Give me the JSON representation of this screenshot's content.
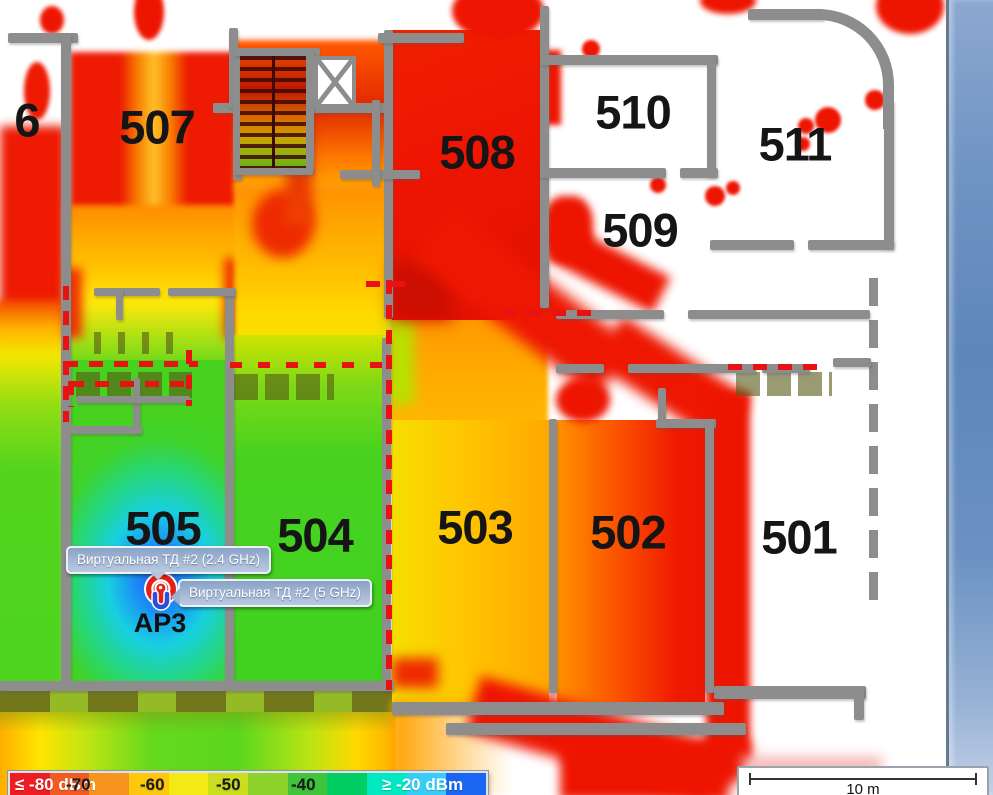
{
  "map": {
    "rooms": [
      {
        "id": "506",
        "label": "6"
      },
      {
        "id": "507",
        "label": "507"
      },
      {
        "id": "508",
        "label": "508"
      },
      {
        "id": "510",
        "label": "510"
      },
      {
        "id": "511",
        "label": "511"
      },
      {
        "id": "509",
        "label": "509"
      },
      {
        "id": "505",
        "label": "505"
      },
      {
        "id": "504",
        "label": "504"
      },
      {
        "id": "503",
        "label": "503"
      },
      {
        "id": "502",
        "label": "502"
      },
      {
        "id": "501",
        "label": "501"
      }
    ]
  },
  "ap": {
    "label": "AP3",
    "tooltip_24ghz": "Виртуальная ТД #2 (2.4 GHz)",
    "tooltip_5ghz": "Виртуальная ТД #2 (5 GHz)"
  },
  "legend": {
    "segments": [
      "#ee1c23",
      "#f15b22",
      "#f7941d",
      "#fdc70c",
      "#f3ea15",
      "#cadd1f",
      "#8ed32c",
      "#3fc43c",
      "#00ce62",
      "#00e9c2",
      "#38cdf6",
      "#1a65f2"
    ],
    "labels": [
      {
        "text": "≤ -80 dBm",
        "color": "#ffffff",
        "x": 5
      },
      {
        "text": "-70",
        "color": "#1a1a1a",
        "x": 56
      },
      {
        "text": "-60",
        "color": "#1a1a1a",
        "x": 130
      },
      {
        "text": "-50",
        "color": "#1a1a1a",
        "x": 206
      },
      {
        "text": "-40",
        "color": "#1a1a1a",
        "x": 281
      },
      {
        "text": "≥ -20 dBm",
        "color": "#ffffff",
        "x": 372
      }
    ]
  },
  "scale_bar": {
    "label": "10 m"
  },
  "colors": {
    "wall": "#8d8d8d",
    "attenuation_wall": "#e81212",
    "tooltip_bg": "#a7bad7",
    "panel_edge_blue": "#6b92c2",
    "heat_weak_red": "#ee1c23",
    "heat_mid_orange": "#f7941d",
    "heat_good_green": "#47d220",
    "heat_strong_cyan": "#17d6cf",
    "heat_strongest_blue": "#1f57f2"
  }
}
